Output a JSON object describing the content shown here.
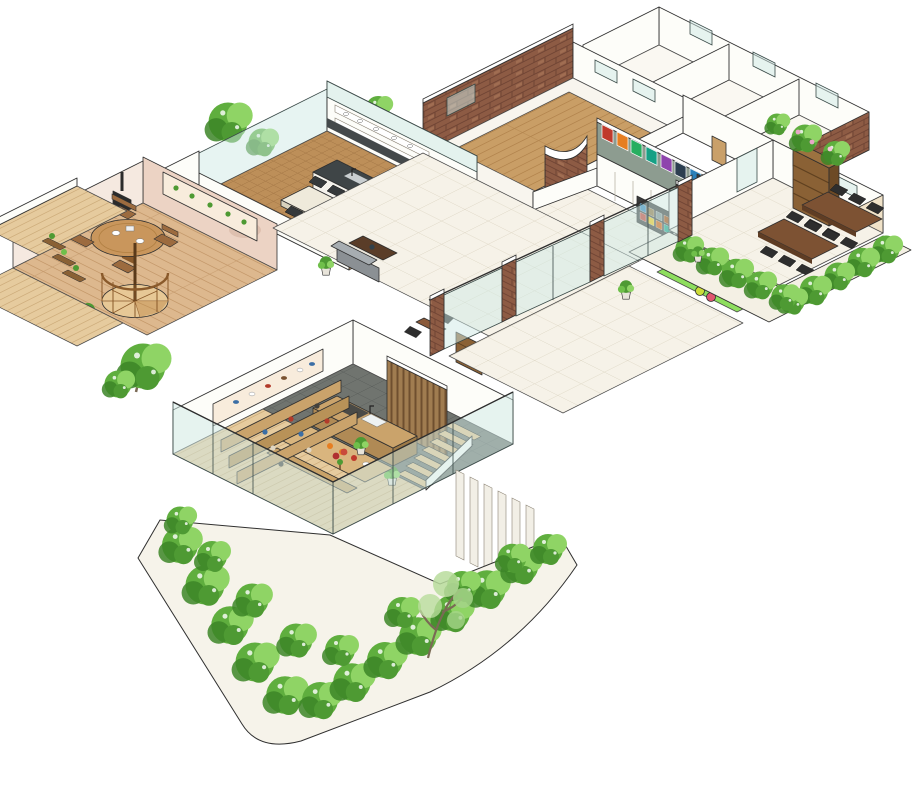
{
  "scene": {
    "type": "isometric-architectural-cutaway-illustration",
    "style": "hand-drawn watercolor floor plan, 2:1 isometric, ink outlines",
    "background": "#ffffff"
  },
  "palette": {
    "paper": "#ffffff",
    "ink": "#2f2f2f",
    "tile_floor": "#f6f2e8",
    "tile_line": "#ddd6c4",
    "wood_hall": "#c99e66",
    "wood_dining": "#ddb88e",
    "wood_herringbone": "#bd8f59",
    "slate_floor": "#70746f",
    "deck_wood": "#e6cb9e",
    "brick": "#8d5b44",
    "brick_dark": "#6f4434",
    "glass": "#cfe9e6",
    "wall_white": "#fdfdf9",
    "cream_wall": "#f0e2c8",
    "pink_wall": "#ecd3c4",
    "niche_cream": "#f8ecdc",
    "poster_wall": "#8d9c90",
    "kids_mat": "#8ede5e",
    "hedge": "#5fae3e",
    "hedge_dark": "#3c8527",
    "hedge_light": "#8fd465",
    "sofa_gray": "#8b9094",
    "sofa_beige": "#cdb694",
    "table_walnut": "#7d5233",
    "counter_wood": "#caa36b",
    "stair_wood": "#e2c08c",
    "spiral_wood": "#e7c896",
    "rack_dark": "#3a3a3a",
    "planter_box": "#f4f0e4",
    "poster_colors": [
      "#c0392b",
      "#e67e22",
      "#27ae60",
      "#16a085",
      "#8e44ad",
      "#2c3e50",
      "#2980b9"
    ],
    "book_spines": [
      "#d35400",
      "#c0392b",
      "#16a085",
      "#8d6e3b",
      "#f1c40f",
      "#7f8c8d",
      "#2980b9",
      "#a04000"
    ],
    "kids_blocks": [
      "#f2a0b4",
      "#d94f4f",
      "#7ac943"
    ],
    "kids_balls": [
      "#cddc39",
      "#e05570"
    ]
  },
  "regions": [
    {
      "id": "great-hall",
      "label": "great hall with wood floor and brick walls"
    },
    {
      "id": "ne-rooms",
      "label": "back rooms with windows"
    },
    {
      "id": "kitchen",
      "label": "open kitchen and dining with island"
    },
    {
      "id": "dining-room",
      "label": "dining room with round table and fireplace"
    },
    {
      "id": "spiral-staircase",
      "label": "wooden spiral staircase"
    },
    {
      "id": "gallery-lounge",
      "label": "gallery lounge with poster wall"
    },
    {
      "id": "magazine-racks",
      "label": "magazine display racks"
    },
    {
      "id": "kids-play-area",
      "label": "kids play mat with soft blocks"
    },
    {
      "id": "study-room",
      "label": "study room with tables and bookshelf"
    },
    {
      "id": "plaza",
      "label": "central tiled plaza"
    },
    {
      "id": "corridor-glass",
      "label": "glass corridor with brick piers"
    },
    {
      "id": "terrace",
      "label": "outdoor tiled terrace"
    },
    {
      "id": "cafe",
      "label": "cafe kitchen with counter, tiered seating and stairs"
    },
    {
      "id": "garden",
      "label": "hedge planters and tree"
    }
  ]
}
